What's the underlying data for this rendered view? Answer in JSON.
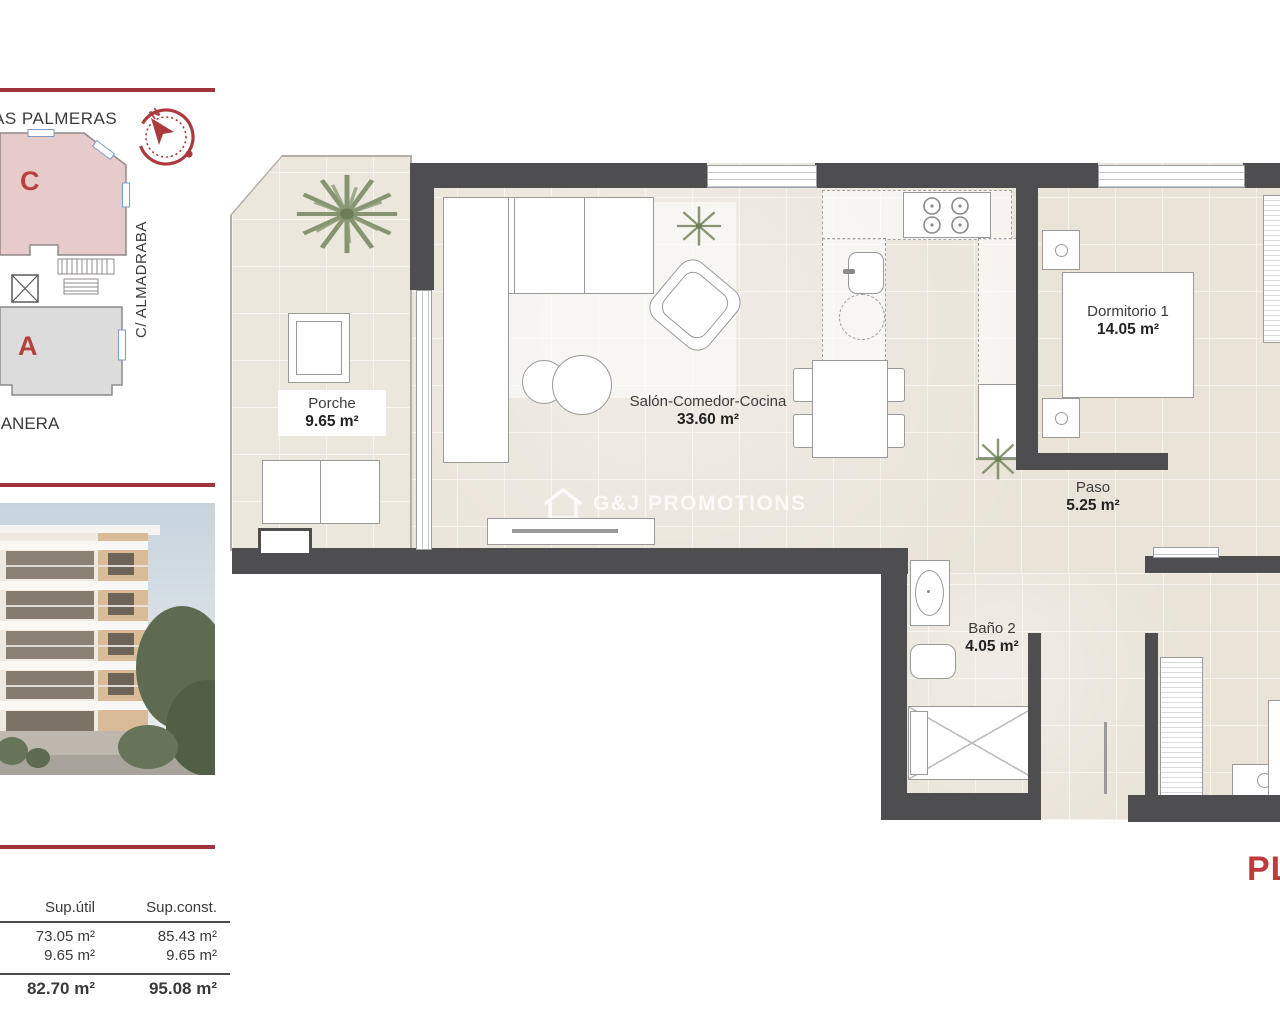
{
  "watermark": {
    "text": "G&J PROMOTIONS"
  },
  "plan_sheet_label": "PL",
  "site_plan": {
    "street_top": "AS PALMERAS",
    "street_right": "C/ ALMADRABA",
    "street_bottom": "IANERA",
    "block_c": "C",
    "block_a": "A",
    "compass_north": "N"
  },
  "rooms": {
    "porche": {
      "name": "Porche",
      "area": "9.65 m²"
    },
    "salon": {
      "name": "Salón-Comedor-Cocina",
      "area": "33.60 m²"
    },
    "dormitorio1": {
      "name": "Dormitorio 1",
      "area": "14.05 m²"
    },
    "paso": {
      "name": "Paso",
      "area": "5.25 m²"
    },
    "bano2": {
      "name": "Baño 2",
      "area": "4.05 m²"
    }
  },
  "areas_table": {
    "headers": [
      "Sup.útil",
      "Sup.const."
    ],
    "rows": [
      [
        "73.05 m²",
        "85.43 m²"
      ],
      [
        "9.65 m²",
        "9.65 m²"
      ]
    ],
    "totals": [
      "82.70 m²",
      "95.08 m²"
    ]
  }
}
